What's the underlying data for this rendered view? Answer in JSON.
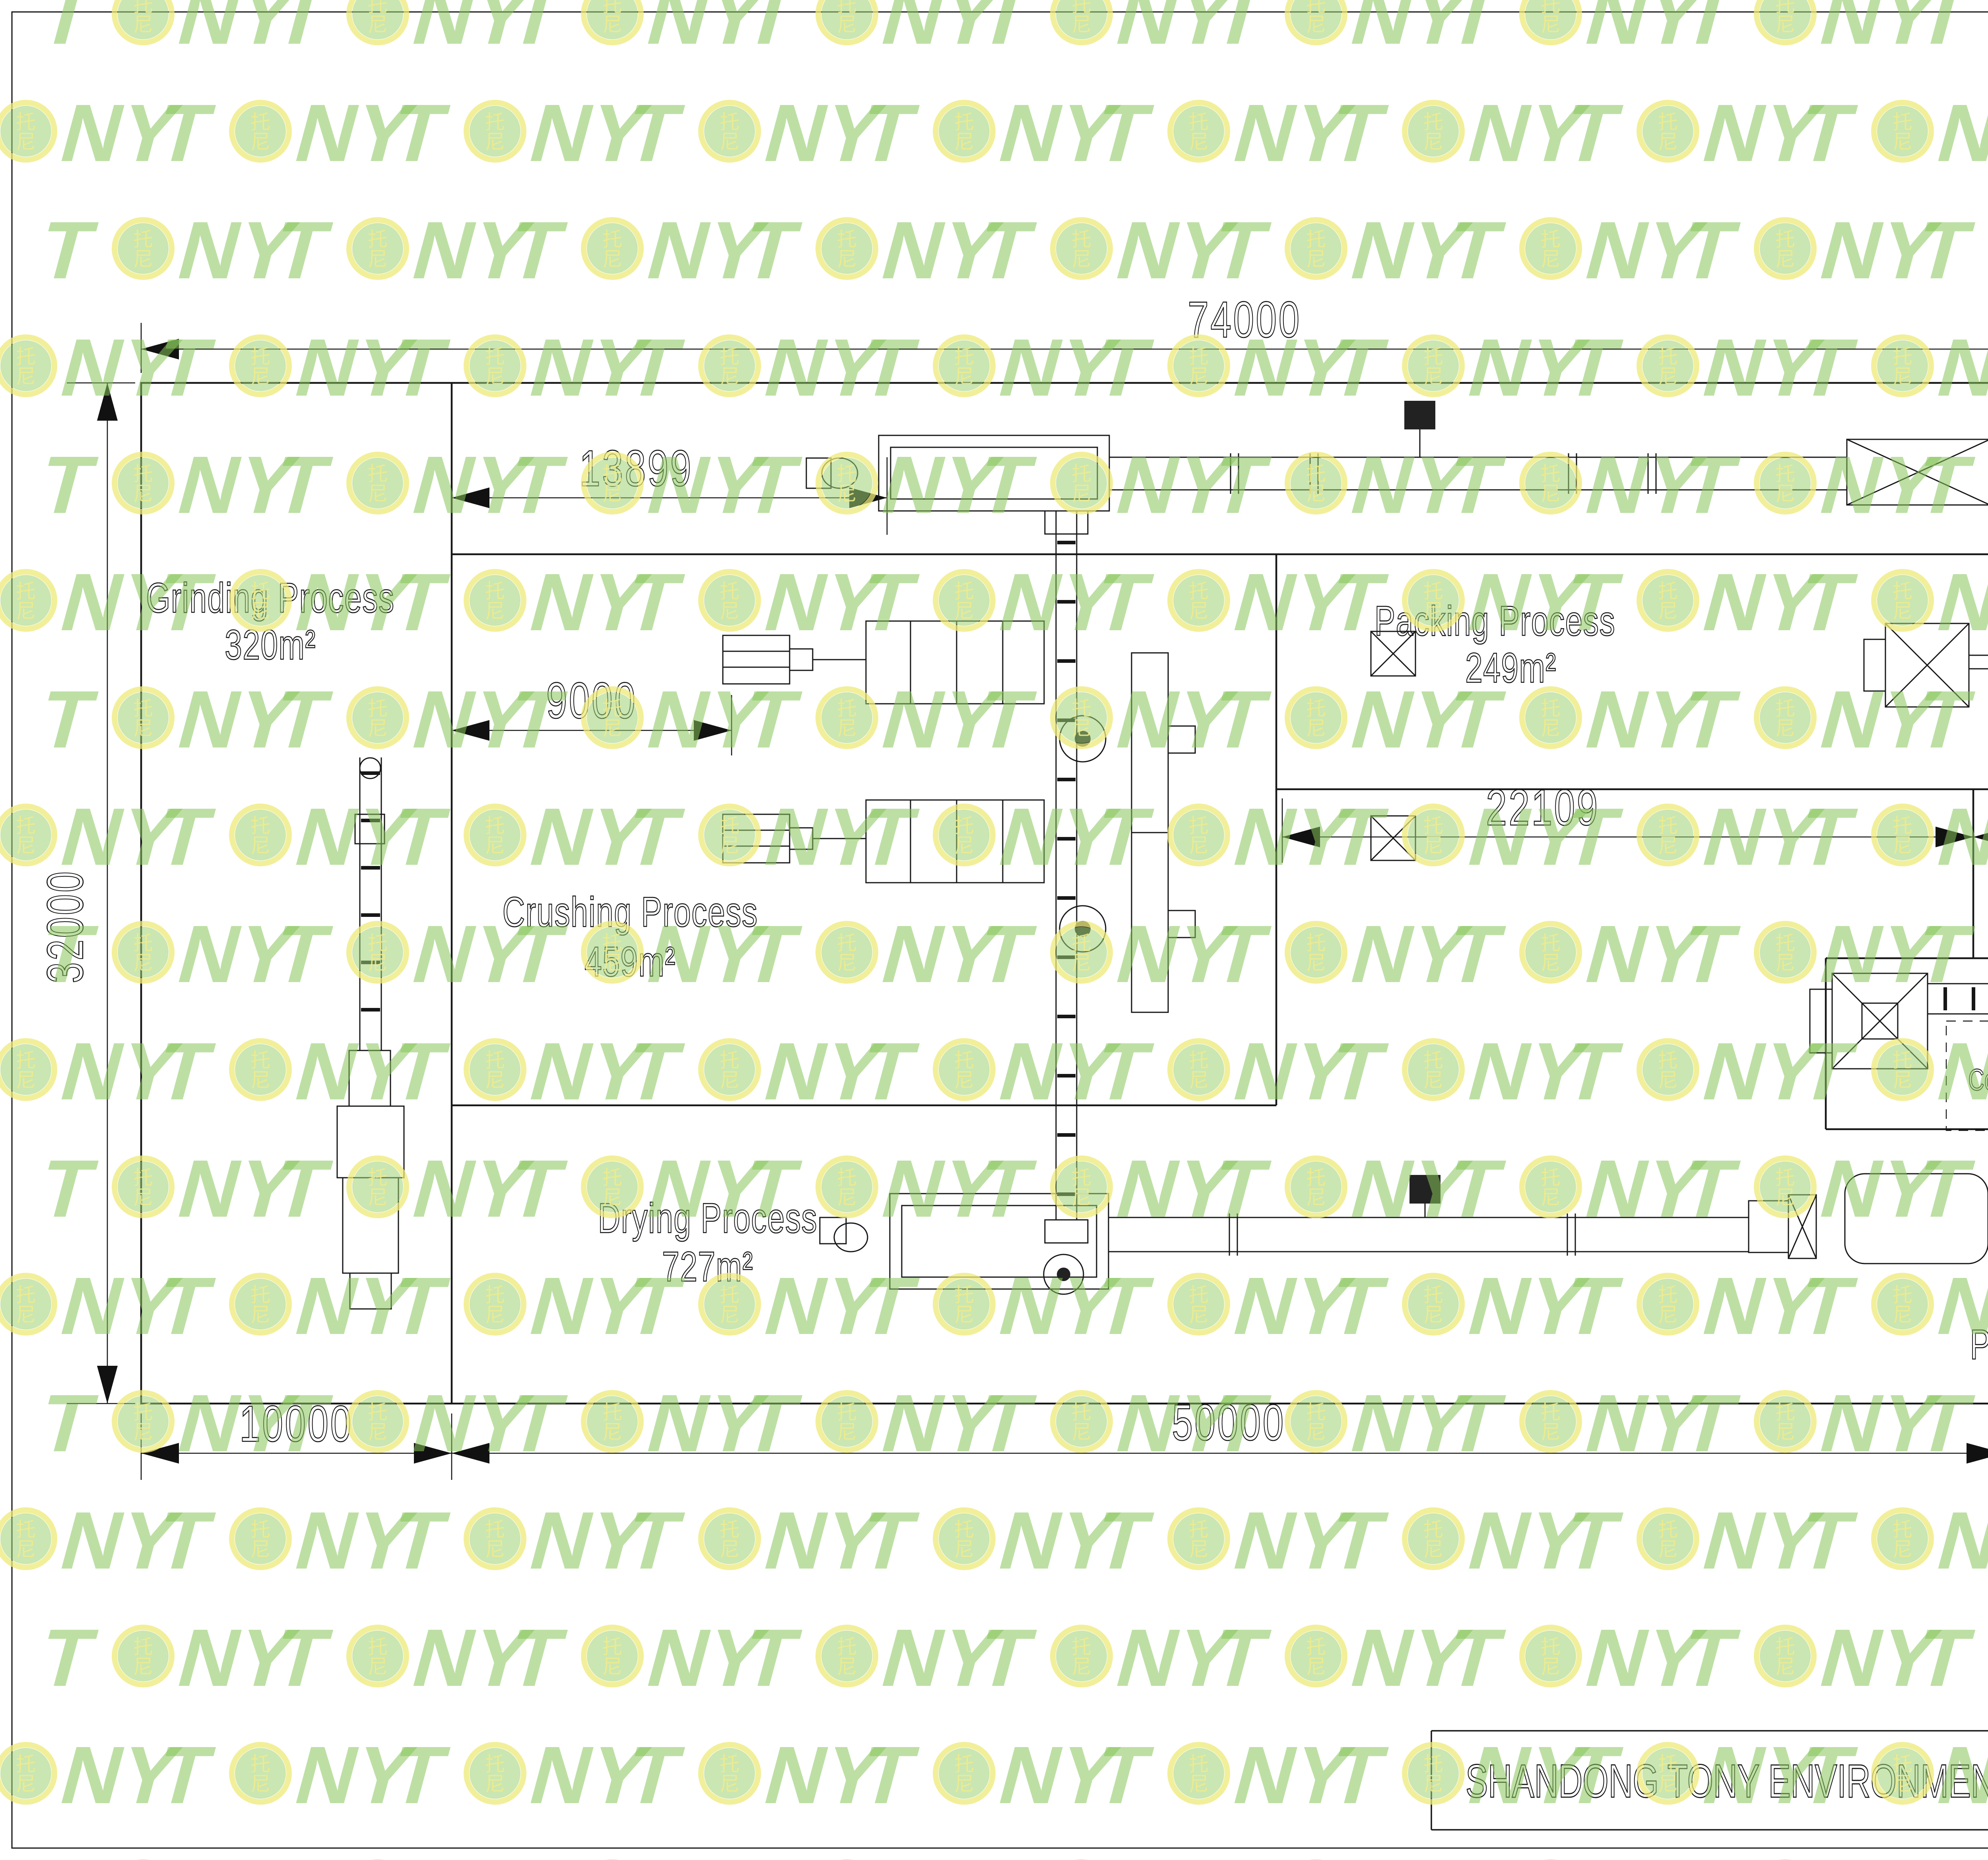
{
  "sheet": {
    "background": "#ffffff",
    "line_color": "#161616"
  },
  "title_block": {
    "company": "SHANDONG TONY ENVIRONMENTAL PROTECTION SCI-TECH CO.,LTD"
  },
  "watermark": {
    "letter_t": "T",
    "letter_n": "N",
    "letter_y": "Y",
    "logo_char_top": "托",
    "logo_char_bottom": "尼",
    "text_color": "#86c55a",
    "ring_color": "#eeea78",
    "disc_color": "#9ed273",
    "glyph_color": "#f0eb8c"
  },
  "process_areas": {
    "grinding": {
      "name": "Grinding Process",
      "area": "320m²"
    },
    "crushing": {
      "name": "Crushing Process",
      "area": "459m²"
    },
    "packing": {
      "name": "Packing Process",
      "area": "249m²"
    },
    "cooling": {
      "name": "Cooling Process",
      "area": "82m²"
    },
    "drying": {
      "name": "Drying Process",
      "area": "727m²"
    },
    "pelletizing": {
      "name": "Pelletizing Process",
      "area": "231m²"
    }
  },
  "dimensions": {
    "overall_width": "74000",
    "overall_height": "32000",
    "top_band_height": "8000",
    "mid_band_height": "13000",
    "bottom_band_height": "11000",
    "grinding_width": "10000",
    "middle_width": "50000",
    "right_width": "14000",
    "corridor_width": "13899",
    "crusher_offset": "9000",
    "packing_span_left": "22109",
    "packing_span_right": "7891"
  }
}
